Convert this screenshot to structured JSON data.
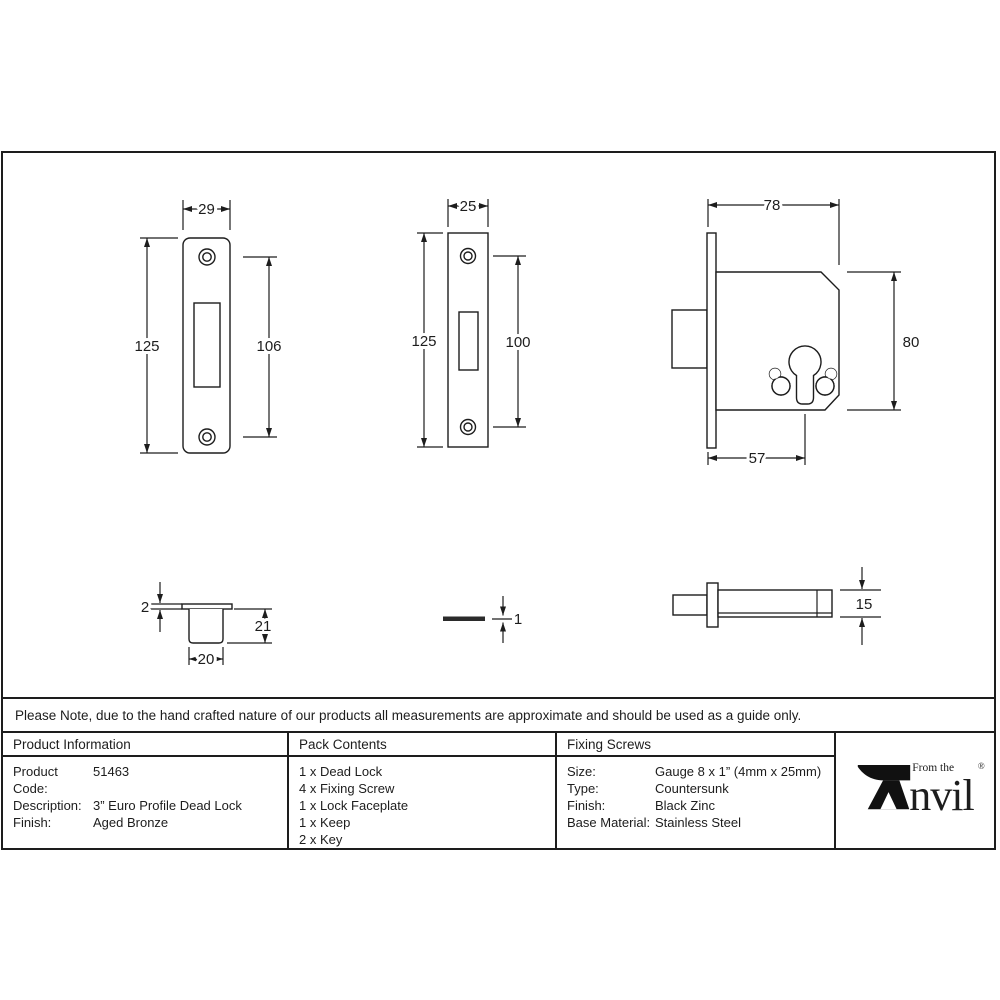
{
  "colors": {
    "ink": "#1d1d1d"
  },
  "note": {
    "text": "Please Note, due to the hand crafted nature of our products all measurements are approximate and should be used as a guide only."
  },
  "drawings": {
    "keep_faceplate_front": {
      "width": "29",
      "height": "125",
      "hole_spacing": "106"
    },
    "lock_faceplate_front": {
      "width": "25",
      "height": "125",
      "hole_spacing": "100"
    },
    "lock_body_front": {
      "case_depth": "78",
      "case_height": "80",
      "backset": "57"
    },
    "keep_side": {
      "flange_thickness": "2",
      "depth": "21",
      "width": "20"
    },
    "faceplate_side": {
      "thickness": "1"
    },
    "lock_body_side": {
      "thickness": "15"
    }
  },
  "table": {
    "product_information": {
      "header": "Product Information",
      "rows": [
        {
          "label": "Product Code:",
          "value": "51463"
        },
        {
          "label": "Description:",
          "value": "3” Euro Profile Dead Lock"
        },
        {
          "label": "Finish:",
          "value": "Aged Bronze"
        }
      ]
    },
    "pack_contents": {
      "header": "Pack Contents",
      "items": [
        "1 x Dead Lock",
        "4 x Fixing Screw",
        "1 x Lock Faceplate",
        "1 x Keep",
        "2 x Key"
      ]
    },
    "fixing_screws": {
      "header": "Fixing Screws",
      "rows": [
        {
          "label": "Size:",
          "value": "Gauge 8 x 1” (4mm x 25mm)"
        },
        {
          "label": "Type:",
          "value": "Countersunk"
        },
        {
          "label": "Finish:",
          "value": "Black Zinc"
        },
        {
          "label": "Base Material:",
          "value": "Stainless Steel"
        }
      ]
    },
    "brand": {
      "prefix": "From the",
      "name_rest": "nvil",
      "registered": "®"
    }
  }
}
